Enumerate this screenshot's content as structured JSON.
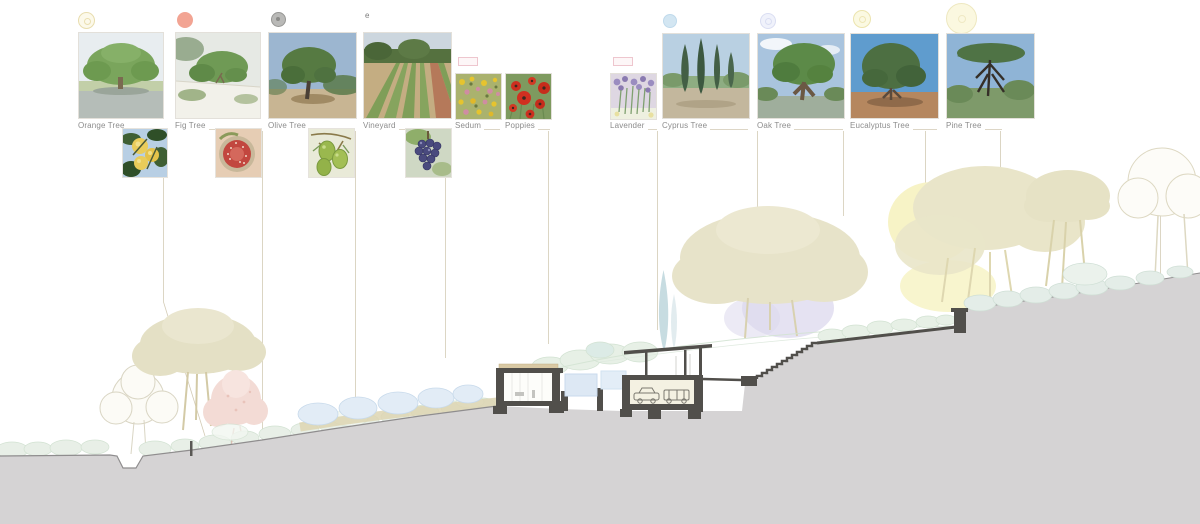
{
  "legend": {
    "items": [
      {
        "label": "Orange Tree",
        "icon": "citrus-ring-icon"
      },
      {
        "label": "Fig Tree",
        "icon": "coral-dot-icon"
      },
      {
        "label": "Olive Tree",
        "icon": "gray-tree-dot-icon"
      },
      {
        "label": "Vineyard",
        "icon": "letter-marker",
        "marker": "e"
      },
      {
        "label": "Sedum",
        "icon": "pink-rect-icon"
      },
      {
        "label": "Poppies",
        "icon": "none"
      },
      {
        "label": "Lavender",
        "icon": "pink-rect-icon"
      },
      {
        "label": "Cyprus Tree",
        "icon": "blue-dot-icon"
      },
      {
        "label": "Oak Tree",
        "icon": "pale-blue-ring-icon"
      },
      {
        "label": "Eucalyptus Tree",
        "icon": "yellow-ring-icon"
      },
      {
        "label": "Pine Tree",
        "icon": "yellow-ring-large-icon"
      }
    ]
  },
  "colors": {
    "label_gray": "#8c8c8c",
    "leader_tan": "#cbc2a8",
    "terrain_gray": "#d5d3d4",
    "terrain_edge": "#8f8d8e",
    "structure_dark": "#514f4b",
    "roof_tan": "#d9c9a4",
    "water_blue": "#dde8f4",
    "boulder_blue": "#e2ecf6",
    "tree_beige": "#e7e3c9",
    "tree_yellow": "#f7f3c6",
    "tree_pink": "#f3dbd5",
    "cypress_blue": "#c7dce1",
    "shadow_lavender": "#dcd8ed",
    "bush_green": "#e8efe7",
    "underbrush_tan": "#ddd5b2"
  }
}
